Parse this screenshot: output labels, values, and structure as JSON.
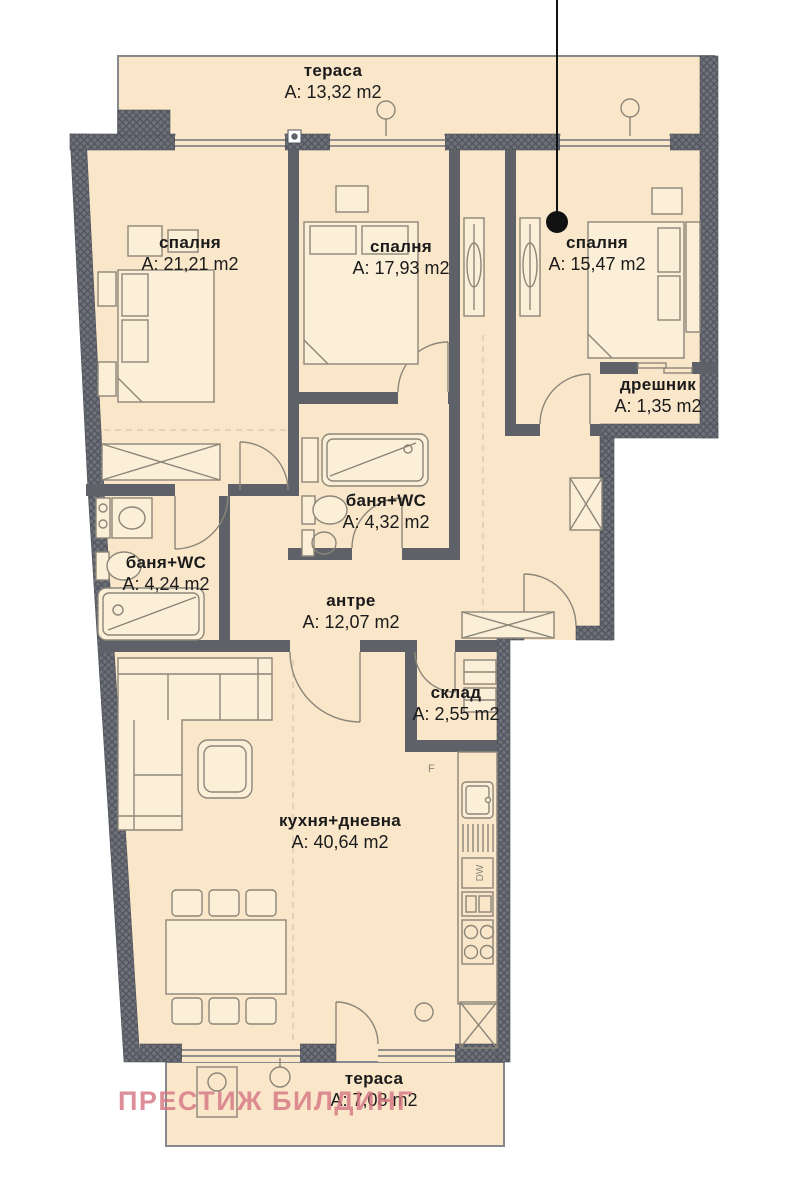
{
  "watermark": "ПРЕСТИЖ БИЛДИНГ",
  "rooms": {
    "terrace_top": {
      "name": "тераса",
      "area": "A: 13,32 m2"
    },
    "bedroom_1": {
      "name": "спалня",
      "area": "A: 21,21 m2"
    },
    "bedroom_2": {
      "name": "спалня",
      "area": "A: 17,93 m2"
    },
    "bedroom_3": {
      "name": "спалня",
      "area": "A: 15,47 m2"
    },
    "closet": {
      "name": "дрешник",
      "area": "A: 1,35 m2"
    },
    "bath_right": {
      "name": "баня+WC",
      "area": "A: 4,32 m2"
    },
    "bath_left": {
      "name": "баня+WC",
      "area": "A: 4,24 m2"
    },
    "hall": {
      "name": "антре",
      "area": "A: 12,07 m2"
    },
    "storage": {
      "name": "склад",
      "area": "A: 2,55 m2"
    },
    "kitchen": {
      "name": "кухня+дневна",
      "area": "A: 40,64 m2"
    },
    "terrace_bottom": {
      "name": "тераса",
      "area": "A: 7,08 m2"
    }
  },
  "appliance_labels": {
    "dishwasher": "DW",
    "fridge_marker": "F"
  },
  "colors": {
    "floor": "#fae7ca",
    "wall": "#5e6167",
    "watermark": "#d67682"
  }
}
